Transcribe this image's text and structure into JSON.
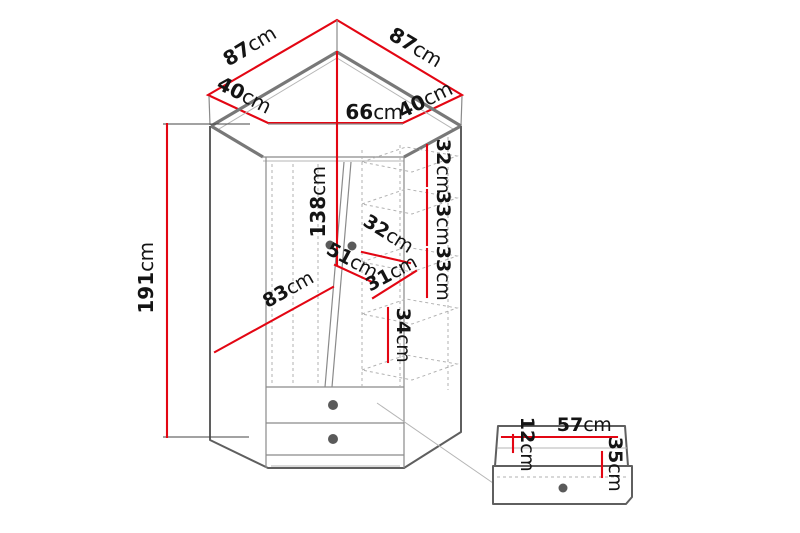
{
  "colors": {
    "dimension_line": "#e30613",
    "outline_dark": "#5f5f5f",
    "outline_mid": "#8a8a8a",
    "hidden_line": "#b2b2b2",
    "label_text": "#141414",
    "background": "#ffffff",
    "handle_dot": "#5a5a5a"
  },
  "dimensions": {
    "top_back_left": {
      "v": "87",
      "u": "cm"
    },
    "top_back_right": {
      "v": "87",
      "u": "cm"
    },
    "top_side_left": {
      "v": "40",
      "u": "cm"
    },
    "top_side_right": {
      "v": "40",
      "u": "cm"
    },
    "top_front_width": {
      "v": "66",
      "u": "cm"
    },
    "total_height": {
      "v": "191",
      "u": "cm"
    },
    "door_height": {
      "v": "138",
      "u": "cm"
    },
    "shelf_spacing_1": {
      "v": "32",
      "u": "cm"
    },
    "shelf_spacing_2": {
      "v": "33",
      "u": "cm"
    },
    "shelf_spacing_3": {
      "v": "33",
      "u": "cm"
    },
    "shelf_depth": {
      "v": "32",
      "u": "cm"
    },
    "inner_width_left": {
      "v": "51",
      "u": "cm"
    },
    "inner_width_right": {
      "v": "31",
      "u": "cm"
    },
    "inner_diagonal_width": {
      "v": "83",
      "u": "cm"
    },
    "bottom_section_height": {
      "v": "34",
      "u": "cm"
    },
    "drawer_width": {
      "v": "57",
      "u": "cm"
    },
    "drawer_top_offset": {
      "v": "12",
      "u": "cm"
    },
    "drawer_front_height": {
      "v": "35",
      "u": "cm"
    }
  }
}
